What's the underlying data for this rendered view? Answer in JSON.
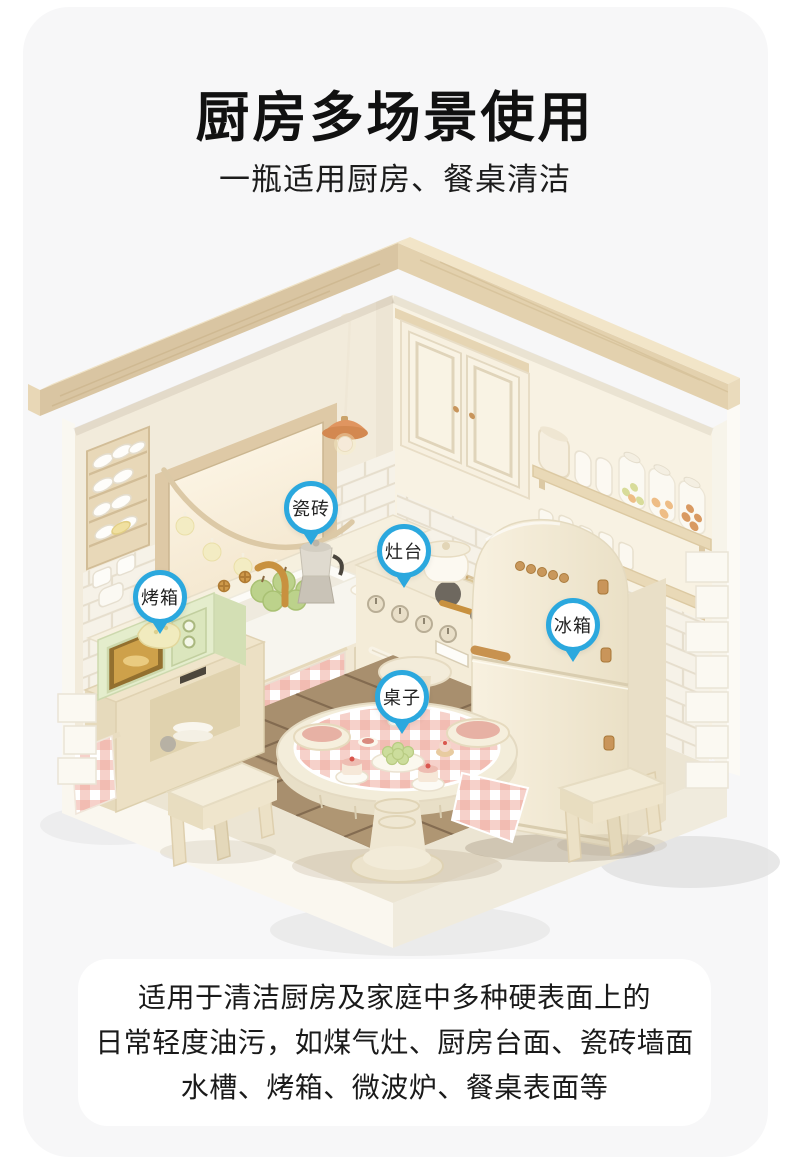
{
  "header": {
    "title": "厨房多场景使用",
    "subtitle": "一瓶适用厨房、餐桌清洁"
  },
  "callouts": [
    {
      "label": "瓷砖"
    },
    {
      "label": "灶台"
    },
    {
      "label": "烤箱"
    },
    {
      "label": "冰箱"
    },
    {
      "label": "桌子"
    }
  ],
  "description": {
    "lines": [
      "适用于清洁厨房及家庭中多种硬表面上的",
      "日常轻度油污，如煤气灶、厨房台面、瓷砖墙面",
      "水槽、烤箱、微波炉、餐桌表面等"
    ]
  },
  "colors": {
    "accent_blue": "#2ba8de",
    "card_background": "#f7f7f8",
    "panel_background": "#ffffff",
    "text": "#1a1a1a"
  }
}
